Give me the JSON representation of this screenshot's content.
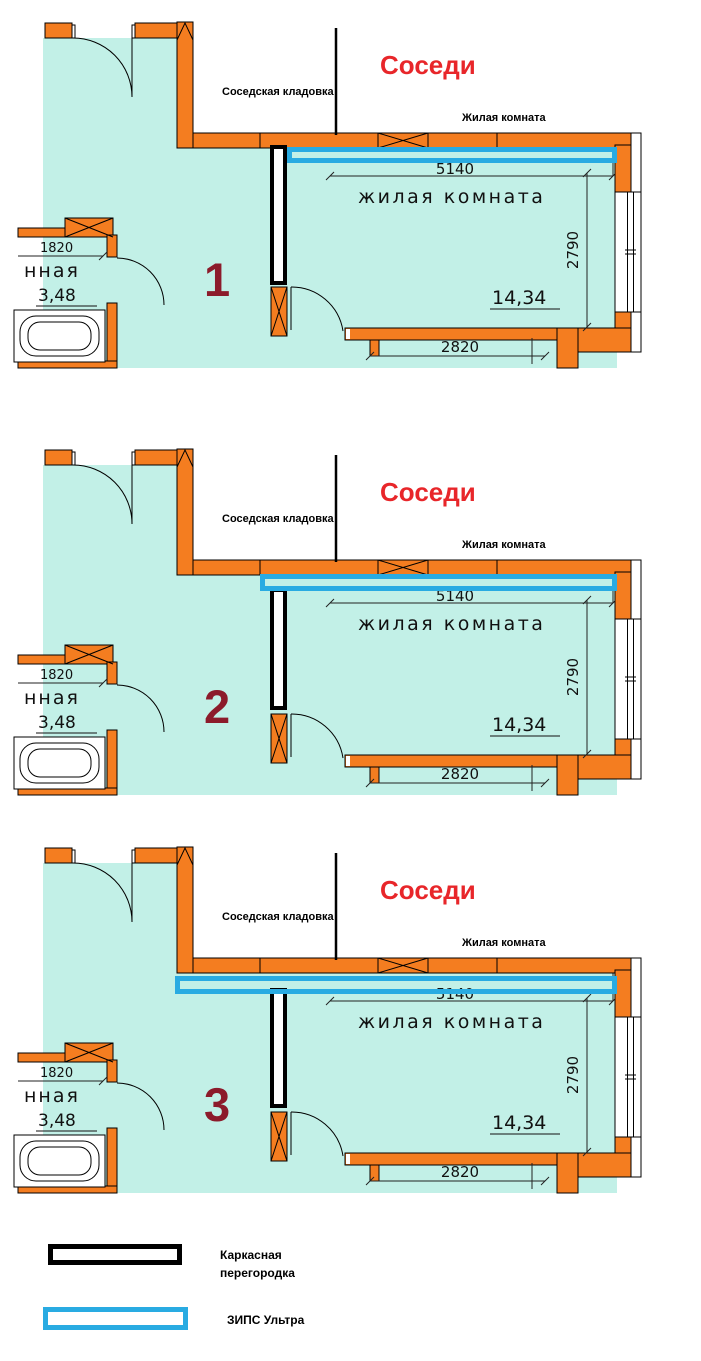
{
  "colors": {
    "wall_orange": "#F47D20",
    "room_teal": "#C2F0E7",
    "zips_blue": "#29ABE2",
    "partition_black": "#000000",
    "neighbors_red": "#E8262A",
    "number_maroon": "#8C1B2B"
  },
  "legend": {
    "frame_label_line1": "Каркасная",
    "frame_label_line2": "перегородка",
    "zips_label": "ЗИПС Ультра"
  },
  "panels": [
    {
      "number": "1",
      "neighbors_title": "Соседи",
      "storage_label": "Соседская кладовка",
      "neighbor_room_label": "Жилая комната",
      "room_label": "жилая комната",
      "dims": {
        "width": "5140",
        "height": "2790",
        "bottom": "2820",
        "left": "1820"
      },
      "areas": {
        "room": "14,34",
        "bath": "3,48"
      },
      "bath_label_fragment": "нная",
      "zips": {
        "x": "289.5",
        "y": "149.5",
        "w": "325",
        "h": "11"
      },
      "partition": {
        "x": "272",
        "y": "147",
        "w": "13",
        "h": "136"
      }
    },
    {
      "number": "2",
      "neighbors_title": "Соседи",
      "storage_label": "Соседская кладовка",
      "neighbor_room_label": "Жилая комната",
      "room_label": "жилая комната",
      "dims": {
        "width": "5140",
        "height": "2790",
        "bottom": "2820",
        "left": "1820"
      },
      "areas": {
        "room": "14,34",
        "bath": "3,48"
      },
      "bath_label_fragment": "нная",
      "zips": {
        "x": "262.5",
        "y": "149.5",
        "w": "352",
        "h": "12"
      },
      "partition": {
        "x": "272",
        "y": "163",
        "w": "13",
        "h": "118"
      }
    },
    {
      "number": "3",
      "neighbors_title": "Соседи",
      "storage_label": "Соседская кладовка",
      "neighbor_room_label": "Жилая комната",
      "room_label": "жилая комната",
      "dims": {
        "width": "5140",
        "height": "2790",
        "bottom": "2820",
        "left": "1820"
      },
      "areas": {
        "room": "14,34",
        "bath": "3,48"
      },
      "bath_label_fragment": "нная",
      "zips": {
        "x": "177.5",
        "y": "153.5",
        "w": "437",
        "h": "13"
      },
      "partition": {
        "x": "272",
        "y": "165",
        "w": "13",
        "h": "116"
      }
    }
  ]
}
